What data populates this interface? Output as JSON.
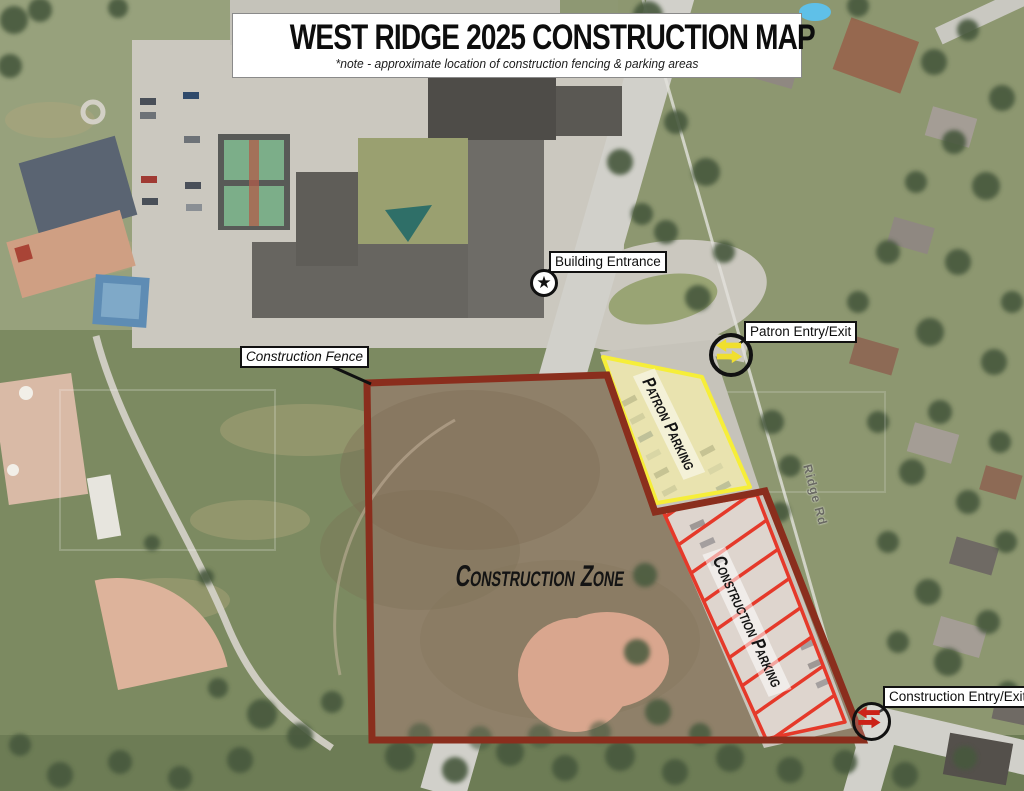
{
  "title": {
    "text": "WEST RIDGE 2025 CONSTRUCTION MAP",
    "note": "*note - approximate location of construction fencing & parking areas"
  },
  "zones": {
    "construction_zone": {
      "label": "Construction Zone"
    },
    "patron_parking": {
      "label": "Patron Parking"
    },
    "construction_parking": {
      "label": "Construction Parking"
    }
  },
  "markers": {
    "building_entrance": {
      "label": "Building Entrance",
      "glyph": "★",
      "icon": "star-icon"
    },
    "patron_entry_exit": {
      "label": "Patron Entry/Exit",
      "icon": "yellow-two-way-arrows-icon"
    },
    "construction_fence": {
      "label": "Construction Fence"
    },
    "construction_entry_exit": {
      "label": "Construction Entry/Exit",
      "icon": "red-two-way-arrows-icon"
    }
  },
  "streets": {
    "ridge_rd": "Ridge Rd"
  },
  "colors": {
    "darkred": "#8a2e1d",
    "red": "#e5392a",
    "yellow": "#f6ee39",
    "yellowfill": "#f6f0aa",
    "dirt": "#8f8069",
    "road": "#d1d0ca",
    "pave": "#cbc8bf",
    "ink": "#141414",
    "labelbg": "#ffffff",
    "labelborder": "#111111",
    "arrowyellow": "#f0df2e",
    "arrowred": "#cc2218"
  }
}
